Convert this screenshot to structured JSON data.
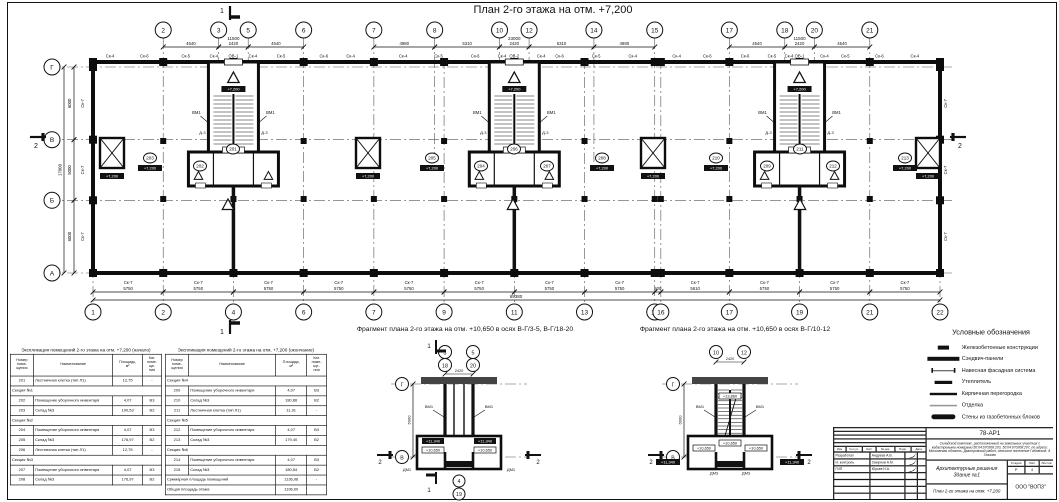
{
  "title": "План 2-го этажа на отм. +7,200",
  "plan": {
    "axes_top": [
      [
        "2",
        5750
      ],
      [
        "3",
        10290
      ],
      [
        "5",
        12710
      ],
      [
        "6",
        17250
      ],
      [
        "7",
        23000
      ],
      [
        "8",
        27980
      ],
      [
        "10",
        33290
      ],
      [
        "12",
        35710
      ],
      [
        "14",
        41020
      ],
      [
        "15",
        46000
      ],
      [
        "17",
        52110
      ],
      [
        "18",
        56650
      ],
      [
        "20",
        59070
      ],
      [
        "21",
        63610
      ]
    ],
    "axes_bottom": [
      [
        "1",
        0
      ],
      [
        "2",
        5750
      ],
      [
        "4",
        11500
      ],
      [
        "6",
        17250
      ],
      [
        "7",
        23000
      ],
      [
        "9",
        28750
      ],
      [
        "11",
        34500
      ],
      [
        "13",
        40250
      ],
      [
        "15",
        46000
      ],
      [
        "16",
        46500
      ],
      [
        "17",
        52110
      ],
      [
        "19",
        57860
      ],
      [
        "21",
        63610
      ],
      [
        "22",
        69360
      ]
    ],
    "rows": [
      [
        "Г",
        17000
      ],
      [
        "В",
        11000
      ],
      [
        "Б",
        6000
      ],
      [
        "А",
        0
      ]
    ],
    "dims_top": [
      [
        5750,
        10290,
        "4540"
      ],
      [
        10290,
        12710,
        "2420"
      ],
      [
        12710,
        17250,
        "4540"
      ],
      [
        23000,
        27980,
        "4980"
      ],
      [
        27980,
        33290,
        "5310"
      ],
      [
        33290,
        35710,
        "2420"
      ],
      [
        35710,
        41020,
        "5310"
      ],
      [
        41020,
        46000,
        "4980"
      ],
      [
        52110,
        56650,
        "4540"
      ],
      [
        56650,
        59070,
        "2420"
      ],
      [
        59070,
        63610,
        "4540"
      ]
    ],
    "groups_top": [
      [
        5750,
        17250,
        "11500"
      ],
      [
        23000,
        46000,
        "23000"
      ],
      [
        52110,
        63610,
        "11500"
      ]
    ],
    "dims_bottom": [
      [
        0,
        5750,
        "5750"
      ],
      [
        5750,
        11500,
        "5750"
      ],
      [
        11500,
        17250,
        "5750"
      ],
      [
        17250,
        23000,
        "5750"
      ],
      [
        23000,
        28750,
        "5750"
      ],
      [
        28750,
        34500,
        "5750"
      ],
      [
        34500,
        40250,
        "5750"
      ],
      [
        40250,
        46000,
        "5750"
      ],
      [
        46000,
        46500,
        "500"
      ],
      [
        46500,
        52110,
        "5610"
      ],
      [
        52110,
        57860,
        "5750"
      ],
      [
        57860,
        63610,
        "5750"
      ],
      [
        63610,
        69360,
        "5750"
      ]
    ],
    "overall_bottom": "69380",
    "dims_left": [
      [
        11000,
        17000,
        "6000"
      ],
      [
        6000,
        11000,
        "5000"
      ],
      [
        0,
        6000,
        "6000"
      ]
    ],
    "overall_left": "17000",
    "wall_label_bottom": "Ск-7",
    "wall_label_side": "Ск-7",
    "wall_labels_top": [
      [
        1400,
        "Ск-4"
      ],
      [
        4200,
        "Ск-6"
      ],
      [
        7600,
        "Ск-5"
      ],
      [
        9900,
        "Ск-4"
      ],
      [
        11500,
        "ОВ-1"
      ],
      [
        13100,
        "Ск-4"
      ],
      [
        15400,
        "Ск-5"
      ],
      [
        18900,
        "Ск-6"
      ],
      [
        21100,
        "Ск-4"
      ],
      [
        25400,
        "Ск-4"
      ],
      [
        28300,
        "Ск-5"
      ],
      [
        31300,
        "Ск-6"
      ],
      [
        33500,
        "Ск-4"
      ],
      [
        34500,
        "ОВ-2"
      ],
      [
        36700,
        "Ск-4"
      ],
      [
        38200,
        "Ск-6"
      ],
      [
        41200,
        "Ск-5"
      ],
      [
        44200,
        "Ск-4"
      ],
      [
        47800,
        "Ск-4"
      ],
      [
        50300,
        "Ск-6"
      ],
      [
        53400,
        "Ск-6"
      ],
      [
        55600,
        "Ск-5"
      ],
      [
        57000,
        "Ск-4"
      ],
      [
        57860,
        "ОВ-1"
      ],
      [
        59900,
        "Ск-4"
      ],
      [
        61600,
        "Ск-5"
      ],
      [
        64400,
        "Ск-6"
      ],
      [
        67300,
        "Ск-4"
      ]
    ],
    "cores": [
      11500,
      34500,
      57860
    ],
    "core_text": {
      "vm": "ВМ1",
      "door": "Д-3",
      "elev": "+7,200"
    },
    "shafts_px": [
      100,
      356,
      641,
      916
    ],
    "room_tags": [
      {
        "n": "201",
        "x": 233,
        "y": 149
      },
      {
        "n": "202",
        "x": 200,
        "y": 166
      },
      {
        "n": "203",
        "x": 150,
        "y": 158,
        "box": true
      },
      {
        "n": "204",
        "x": 481,
        "y": 166
      },
      {
        "n": "205",
        "x": 432,
        "y": 158,
        "box": true
      },
      {
        "n": "206",
        "x": 514,
        "y": 149
      },
      {
        "n": "207",
        "x": 547,
        "y": 166
      },
      {
        "n": "208",
        "x": 602,
        "y": 158,
        "box": true
      },
      {
        "n": "209",
        "x": 767,
        "y": 166
      },
      {
        "n": "210",
        "x": 716,
        "y": 158,
        "box": true
      },
      {
        "n": "211",
        "x": 800,
        "y": 149
      },
      {
        "n": "212",
        "x": 833,
        "y": 166
      },
      {
        "n": "213",
        "x": 905,
        "y": 158,
        "box": true
      }
    ],
    "elev_label": "+7,200",
    "marker1": "1",
    "marker2": "2"
  },
  "fragments": [
    {
      "caption": "Фрагмент плана 2-го этажа на отм. +10,650 в осях В-Г/3-5, В-Г/18-20",
      "cx": 459,
      "bub_top": [
        [
          "3",
          "18"
        ],
        [
          "5",
          "20"
        ]
      ],
      "dim": "2420",
      "row_top": "Г",
      "row_bot": "В",
      "vdim": "6000",
      "vm": "ВМ1",
      "dm": "ДМ1",
      "elev_hi": "+11,340",
      "elev_lo": "+10,650",
      "bub_bottom": [
        "4",
        "19"
      ],
      "marker1": "1",
      "marker2": "2",
      "stair": false
    },
    {
      "caption": "Фрагмент плана 2-го этажа на отм. +10,650 в осях В-Г/10-12",
      "cx": 730,
      "bub_top": [
        [
          "10"
        ],
        [
          "12"
        ]
      ],
      "dim": "2420",
      "row_top": "Г",
      "row_bot": "В",
      "vdim": "6000",
      "vm": "ВМ1",
      "dm": "ДМ3",
      "elev_hi": "+11,340",
      "elev_lo": "+10,650",
      "elev_top": "+13,860",
      "bub_bottom": [],
      "marker1": "1",
      "marker2": "2",
      "stair": true
    }
  ],
  "tables": [
    {
      "title": "Экспликация помещений 2-го этажа на отм. +7,200 (начало)",
      "headers": [
        "Номер\nпоме-\nщения",
        "Наименование",
        "Площадь,\nм²",
        "Кат.\nпоме-\nще-\nния"
      ],
      "rows": [
        [
          "201",
          "Лестничная клетка (тип Л1)",
          "12,75",
          "-"
        ],
        [
          "§",
          "Секция №1"
        ],
        [
          "202",
          "Помещение уборочного инвентаря",
          "4,07",
          "В3"
        ],
        [
          "203",
          "Склад №3",
          "190,53",
          "В2"
        ],
        [
          "§",
          "Секция №2"
        ],
        [
          "204",
          "Помещение уборочного инвентаря",
          "4,07",
          "В3"
        ],
        [
          "205",
          "Склад №3",
          "176,97",
          "В2"
        ],
        [
          "206",
          "Лестничная клетка (тип Л1)",
          "12,75",
          "-"
        ],
        [
          "§",
          "Секция №3"
        ],
        [
          "207",
          "Помещение уборочного инвентаря",
          "4,07",
          "В3"
        ],
        [
          "208",
          "Склад №3",
          "176,97",
          "В2"
        ]
      ]
    },
    {
      "title": "Экспликация помещений 2-го этажа на отм. +7,200 (окончание)",
      "headers": [
        "Номер\nпоме-\nщения",
        "Наименование",
        "Площадь,\nм²",
        "Кат.\nпоме-\nще-\nния"
      ],
      "rows": [
        [
          "§",
          "Секция №4"
        ],
        [
          "209",
          "Помещение уборочного инвентаря",
          "4,07",
          "В3"
        ],
        [
          "210",
          "Склад №3",
          "180,86",
          "В2"
        ],
        [
          "211",
          "Лестничная клетка (тип Л1)",
          "11,91",
          "-"
        ],
        [
          "§",
          "Секция №5"
        ],
        [
          "212",
          "Помещение уборочного инвентаря",
          "4,07",
          "В3"
        ],
        [
          "213",
          "Склад №3",
          "179,40",
          "В2"
        ],
        [
          "§",
          "Секция №6"
        ],
        [
          "214",
          "Помещение уборочного инвентаря",
          "4,07",
          "В3"
        ],
        [
          "215",
          "Склад №3",
          "180,54",
          "В2"
        ],
        [
          "T",
          "Суммарная площадь помещений",
          "1136,06",
          "-"
        ],
        [
          "T",
          "Общая площадь этажа",
          "1196,00",
          ""
        ]
      ]
    }
  ],
  "legend": {
    "title": "Условные обозначения",
    "items": [
      {
        "sym": "rc",
        "label": "Железобетонные конструкции"
      },
      {
        "sym": "sandwich",
        "label": "Сэндвич-панели"
      },
      {
        "sym": "facade",
        "label": "Навесная фасадная система"
      },
      {
        "sym": "insulation",
        "label": "Утеплитель"
      },
      {
        "sym": "brick",
        "label": "Кирпичная перегородка"
      },
      {
        "sym": "finish",
        "label": "Отделка"
      },
      {
        "sym": "gasblock",
        "label": "Стены из газобетонных блоков"
      }
    ]
  },
  "stamp": {
    "doc_number": "78-АР1",
    "description": "Складской комплекс, расположенный на земельных участках с кадастровыми номерами 50:04:070308:203, 50:04:070308:207, по адресу: Московская область, Дмитровский район, сельское поселение Габовское, д. Глазово",
    "object": "Архитектурные решения\nЗдание №1",
    "sheet_title": "План 2-го этажа на отм. +7,200",
    "company": "ООО \"ВОПЗ\"",
    "stage_label": "Стадия",
    "sheet_label": "Лист",
    "sheets_label": "Листов",
    "stage": "Р",
    "sheet": "4",
    "sheets": "",
    "cols": [
      "Изм.",
      "Кол.уч.",
      "Лист",
      "№ док.",
      "Подп.",
      "Дата"
    ],
    "signers": [
      {
        "role": "Разработал",
        "name": "Андреев А.В."
      },
      {
        "role": "Н. контроль",
        "name": "Смирнов А.М."
      },
      {
        "role": "ГИП",
        "name": "Юрьев Н.А."
      }
    ]
  }
}
